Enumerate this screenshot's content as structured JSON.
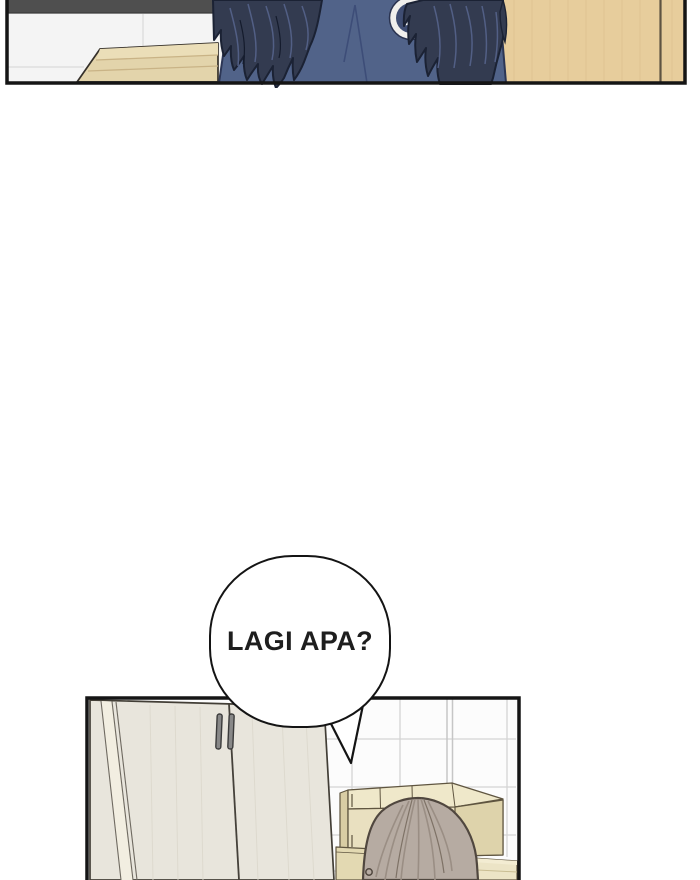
{
  "page": {
    "kind": "webtoon-comic-strip",
    "background_color": "#ffffff",
    "panel_border_color": "#151515"
  },
  "speech_bubble": {
    "text": "LAGI APA?",
    "fill": "#ffffff",
    "outline_color": "#141414",
    "text_color": "#1e1e1e"
  },
  "top_panel": {
    "description": "person with long dark wavy hair in navy jacket seen from behind",
    "wall_color": "#f4f4f4",
    "dark_band_color": "#4f4f4f",
    "counter_color": "#e3d4ab",
    "door_color": "#e7cd9c",
    "jacket_color": "#516389",
    "hair_color": "#333b50",
    "logo": {
      "text": "KI",
      "ring_color": "#f0efec",
      "badge_color": "#3f4d72",
      "text_color": "#ffffff"
    }
  },
  "bottom_panel": {
    "description": "tiled room with wardrobe, cardboard boxes and top of a light-brown-haired head",
    "tile_color": "#fcfcfc",
    "tile_line_color": "#d4d4d4",
    "wardrobe_color": "#e8e5dc",
    "wardrobe_side_color": "#f2eee1",
    "handle_color": "#888888",
    "box_front_color": "#e9e0c0",
    "box_top_color": "#efe8ca",
    "hair_color": "#b6aba2"
  }
}
